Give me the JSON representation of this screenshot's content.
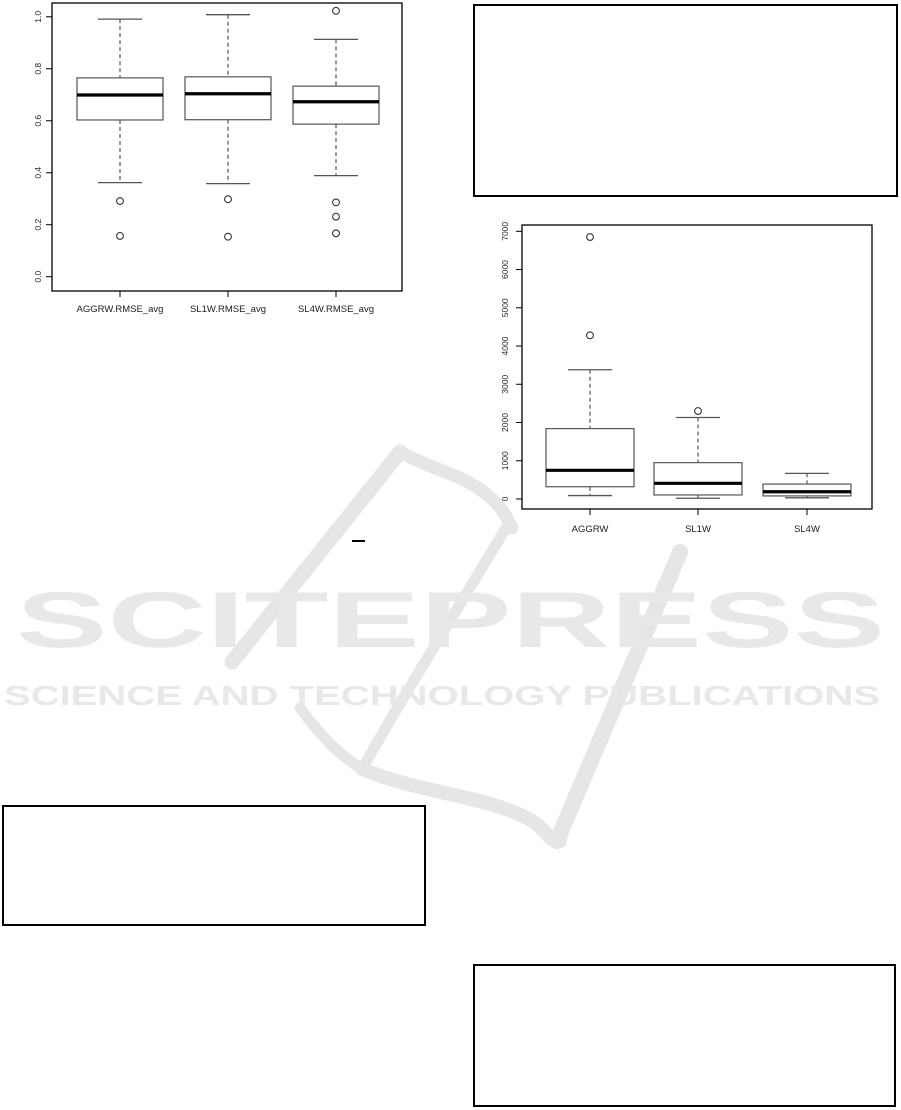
{
  "page": {
    "background": "#ffffff"
  },
  "watermark": {
    "wordmark": "SCITEPRESS",
    "tagline": "SCIENCE AND TECHNOLOGY PUBLICATIONS",
    "text_color": "#e8e8e8",
    "swoosh_color": "#e6e6e6"
  },
  "chart_data": [
    {
      "type": "boxplot",
      "title": "",
      "xlabel": "",
      "ylabel": "",
      "grid": false,
      "categories": [
        "AGGRW.RMSE_avg",
        "SL1W.RMSE_avg",
        "SL4W.RMSE_avg"
      ],
      "yticks": [
        0.0,
        0.2,
        0.4,
        0.6,
        0.8,
        1.0
      ],
      "ytick_labels": [
        "0.0",
        "0.2",
        "0.4",
        "0.6",
        "0.8",
        "1.0"
      ],
      "ylim": [
        -0.055,
        1.053
      ],
      "series": [
        {
          "name": "AGGRW.RMSE_avg",
          "whisker_low": 0.362,
          "q1": 0.603,
          "median": 0.699,
          "q3": 0.765,
          "whisker_high": 0.991,
          "outliers": [
            0.291,
            0.157
          ]
        },
        {
          "name": "SL1W.RMSE_avg",
          "whisker_low": 0.358,
          "q1": 0.604,
          "median": 0.704,
          "q3": 0.769,
          "whisker_high": 1.008,
          "outliers": [
            0.298,
            0.154
          ]
        },
        {
          "name": "SL4W.RMSE_avg",
          "whisker_low": 0.389,
          "q1": 0.587,
          "median": 0.673,
          "q3": 0.733,
          "whisker_high": 0.913,
          "outliers": [
            1.023,
            0.286,
            0.231,
            0.167
          ]
        }
      ]
    },
    {
      "type": "boxplot",
      "title": "",
      "xlabel": "",
      "ylabel": "",
      "grid": false,
      "categories": [
        "AGGRW",
        "SL1W",
        "SL4W"
      ],
      "yticks": [
        0,
        1000,
        2000,
        3000,
        4000,
        5000,
        6000,
        7000
      ],
      "ytick_labels": [
        "0",
        "1000",
        "2000",
        "3000",
        "4000",
        "5000",
        "6000",
        "7000"
      ],
      "ylim": [
        -262,
        7165
      ],
      "series": [
        {
          "name": "AGGRW",
          "whisker_low": 90,
          "q1": 320,
          "median": 750,
          "q3": 1840,
          "whisker_high": 3380,
          "outliers": [
            6850,
            4280
          ]
        },
        {
          "name": "SL1W",
          "whisker_low": 20,
          "q1": 105,
          "median": 410,
          "q3": 950,
          "whisker_high": 2130,
          "outliers": [
            2300
          ]
        },
        {
          "name": "SL4W",
          "whisker_low": 30,
          "q1": 80,
          "median": 190,
          "q3": 390,
          "whisker_high": 670,
          "outliers": []
        }
      ]
    }
  ]
}
